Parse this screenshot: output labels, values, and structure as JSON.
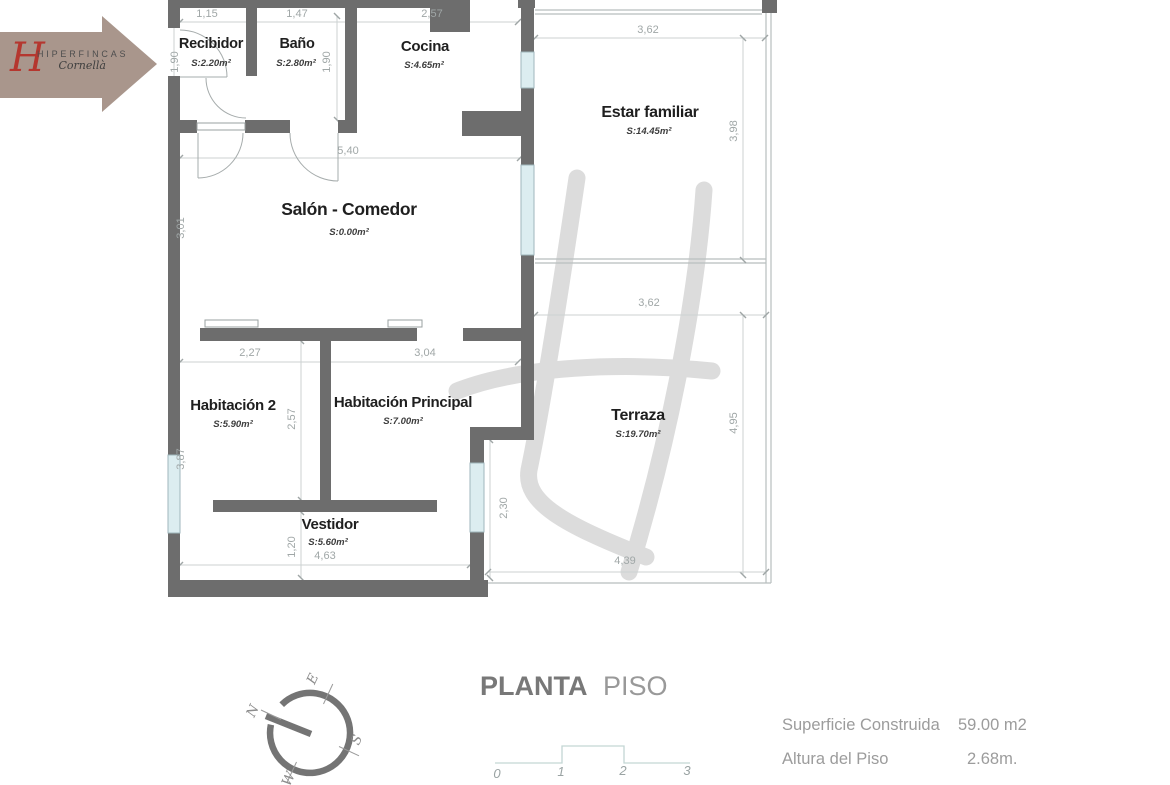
{
  "logo": {
    "monogram": "H",
    "brand": "HIPERFINCAS",
    "tagline": "Cornellà"
  },
  "plan": {
    "rooms": {
      "recibidor": {
        "name": "Recibidor",
        "area": "S:2.20m²"
      },
      "bano": {
        "name": "Baño",
        "area": "S:2.80m²"
      },
      "cocina": {
        "name": "Cocina",
        "area": "S:4.65m²"
      },
      "estar_familiar": {
        "name": "Estar familiar",
        "area": "S:14.45m²"
      },
      "salon_comedor": {
        "name": "Salón - Comedor",
        "area": "S:0.00m²"
      },
      "habitacion_2": {
        "name": "Habitación 2",
        "area": "S:5.90m²"
      },
      "habitacion_principal": {
        "name": "Habitación Principal",
        "area": "S:7.00m²"
      },
      "terraza": {
        "name": "Terraza",
        "area": "S:19.70m²"
      },
      "vestidor": {
        "name": "Vestidor",
        "area": "S:5.60m²"
      }
    },
    "dims": {
      "recibidor_w": "1,15",
      "bano_w": "1,47",
      "cocina_w": "2,57",
      "estar_w": "3,62",
      "entry_h": "1,90",
      "bano_h": "1,90",
      "salon_w": "5,40",
      "salon_h": "3,01",
      "estar_h": "3,98",
      "terraza_w": "3,62",
      "hab2_w": "2,27",
      "habp_w": "3,04",
      "hab2_h": "2,57",
      "terraza_h": "4,95",
      "left_lower_h": "3,87",
      "terraza_left_h": "2,30",
      "vestidor_h": "1,20",
      "vestidor_w": "4,63",
      "terraza_bottom_w": "4,39"
    }
  },
  "compass": {
    "n": "N",
    "e": "E",
    "s": "S",
    "w": "W"
  },
  "title": {
    "primary": "PLANTA",
    "secondary": "PISO"
  },
  "scale_bar": {
    "ticks": [
      "0",
      "1",
      "2",
      "3"
    ]
  },
  "details": {
    "superficie_label": "Superficie Construida",
    "superficie_value": "59.00 m2",
    "altura_label": "Altura del Piso",
    "altura_value": "2.68m."
  }
}
